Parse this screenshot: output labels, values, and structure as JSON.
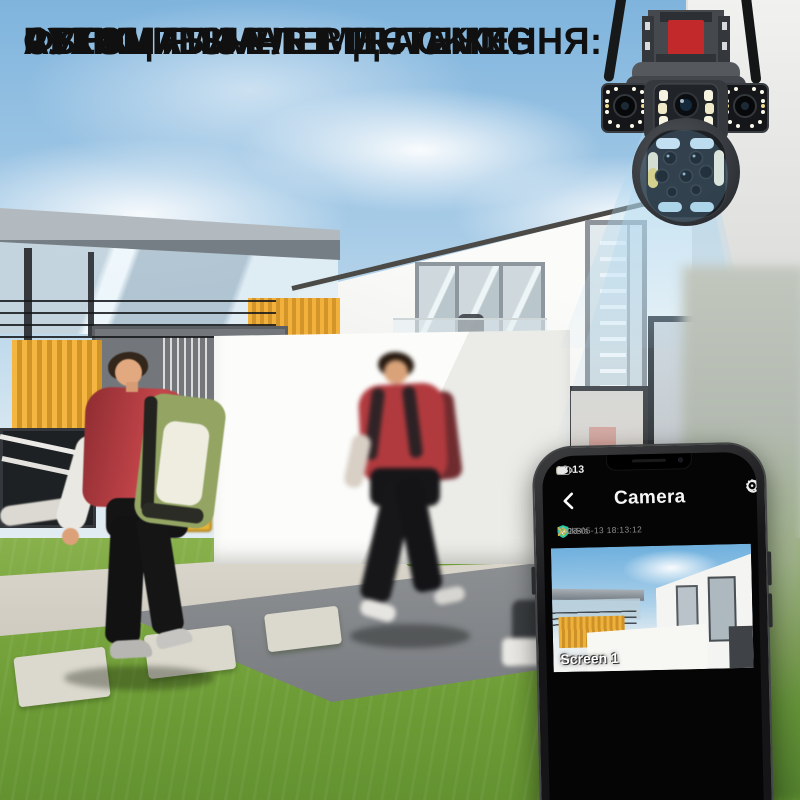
{
  "promo": {
    "line1": "АВТОМАТИЧНЕ ВІДСТЕЖЕННЯ:",
    "line2": "ФУНКЦІЯ SMART TRACKING",
    "line3": "СТЕЖИТЬ ЗА",
    "line4": "РУХОМИМИ ЕЛЕМЕНТАМИ"
  },
  "phone": {
    "status": {
      "time": "18:13"
    },
    "header": {
      "title": "Camera",
      "settings_glyph": "⚙"
    },
    "info": {
      "timestamp": "2023-05-13 18:13:12",
      "speed": "200kB/s"
    },
    "screens": {
      "s1": "Screen 1",
      "s2": "Screen 2",
      "s3": "Screen 3"
    }
  },
  "colors": {
    "camera_accent_red": "#c2292b",
    "shield_green": "#2fc7a8",
    "speed_yellow": "#e5c02e",
    "beam_blue": "#aed7f0",
    "grass_green": "#6d9c36"
  }
}
